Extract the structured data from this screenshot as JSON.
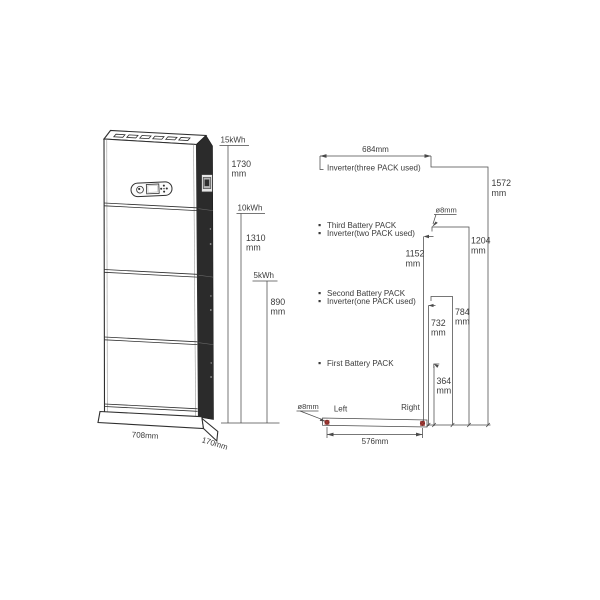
{
  "colors": {
    "line": "#4a4a4a",
    "side_panel": "#2b2b2b",
    "hole_marker": "#7d2e2e"
  },
  "left_view": {
    "capacity_marks": [
      {
        "capacity": "15kWh",
        "value": "1730",
        "unit": "mm"
      },
      {
        "capacity": "10kWh",
        "value": "1310",
        "unit": "mm"
      },
      {
        "capacity": "5kWh",
        "value": "890",
        "unit": "mm"
      }
    ],
    "width": "708mm",
    "depth": "170mm"
  },
  "mount_view": {
    "top_width": "684mm",
    "total_height": {
      "value": "1572",
      "unit": "mm"
    },
    "hole_top": "ø8mm",
    "hole_bottom": "ø8mm",
    "levels": {
      "inverter_three": "Inverter(three PACK used)",
      "third_pack": "Third Battery PACK",
      "inverter_two": "Inverter(two PACK used)",
      "second_pack": "Second Battery PACK",
      "inverter_one": "Inverter(one PACK used)",
      "first_pack": "First Battery PACK"
    },
    "heights": {
      "h1204": {
        "value": "1204",
        "unit": "mm"
      },
      "h1152": {
        "value": "1152",
        "unit": "mm"
      },
      "h784": {
        "value": "784",
        "unit": "mm"
      },
      "h732": {
        "value": "732",
        "unit": "mm"
      },
      "h364": {
        "value": "364",
        "unit": "mm"
      }
    },
    "left_label": "Left",
    "right_label": "Right",
    "bottom_width": "576mm"
  }
}
